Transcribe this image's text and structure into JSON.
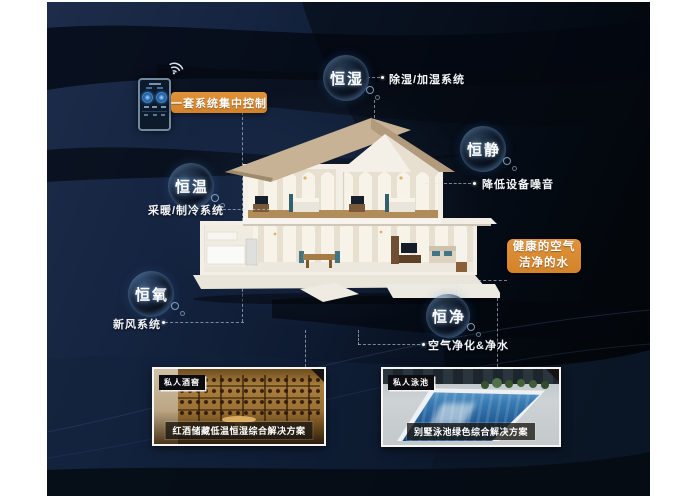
{
  "callouts": {
    "control": {
      "label": "一套系统集中控制"
    },
    "health": {
      "line1": "健康的空气",
      "line2": "洁净的水"
    }
  },
  "bubbles": {
    "hengshi": {
      "label": "恒湿",
      "note": "除湿/加湿系统"
    },
    "hengjing": {
      "label": "恒静",
      "note": "降低设备噪音"
    },
    "hengwen": {
      "label": "恒温",
      "note": "采暖/制冷系统"
    },
    "hengyang": {
      "label": "恒氧",
      "note": "新风系统"
    },
    "hengjin": {
      "label": "恒净",
      "note": "空气净化&净水"
    }
  },
  "cards": {
    "wine": {
      "tag": "私人酒窖",
      "caption": "红酒储藏低温恒湿综合解决方案"
    },
    "pool": {
      "tag": "私人泳池",
      "caption": "别墅泳池绿色综合解决方案"
    }
  },
  "colors": {
    "accent": "#D98A2C",
    "background": "#101E33"
  }
}
